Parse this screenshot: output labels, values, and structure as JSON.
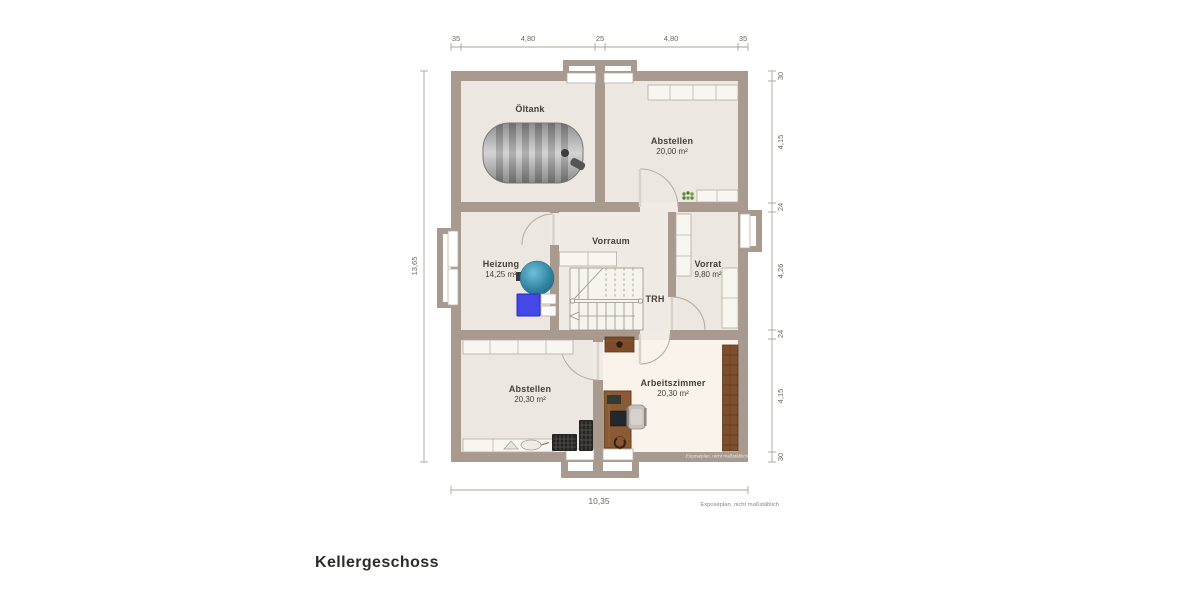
{
  "meta": {
    "title": "Kellergeschoss",
    "footnote": "Exposéplan, nicht maßstäblich",
    "watermark": "Exposéplan, nicht maßstäblich"
  },
  "rooms": {
    "oeltank": {
      "name": "Öltank"
    },
    "abstellen_top": {
      "name": "Abstellen",
      "area": "20,00 m²"
    },
    "vorraum": {
      "name": "Vorraum"
    },
    "heizung": {
      "name": "Heizung",
      "area": "14,25 m²"
    },
    "vorrat": {
      "name": "Vorrat",
      "area": "9,80 m²"
    },
    "trh": {
      "name": "TRH"
    },
    "abstellen_bottom": {
      "name": "Abstellen",
      "area": "20,30 m²"
    },
    "arbeitszimmer": {
      "name": "Arbeitszimmer",
      "area": "20,30 m²"
    }
  },
  "dimensions": {
    "top": [
      "35",
      "4,80",
      "25",
      "4,80",
      "35"
    ],
    "right": [
      "30",
      "4,15",
      "24",
      "4,26",
      "24",
      "4,15",
      "30"
    ],
    "left": [
      "13,65"
    ],
    "bottom": [
      "10,35"
    ]
  },
  "colors": {
    "wall": "#a89a8f",
    "floor": "#ece7e0",
    "floor_light": "#f9f3ec",
    "boiler_teal": "#2e7f9f",
    "heater_blue": "#4348e6",
    "wood_brown": "#7e4f2c",
    "plant_green": "#5e8b3f"
  }
}
